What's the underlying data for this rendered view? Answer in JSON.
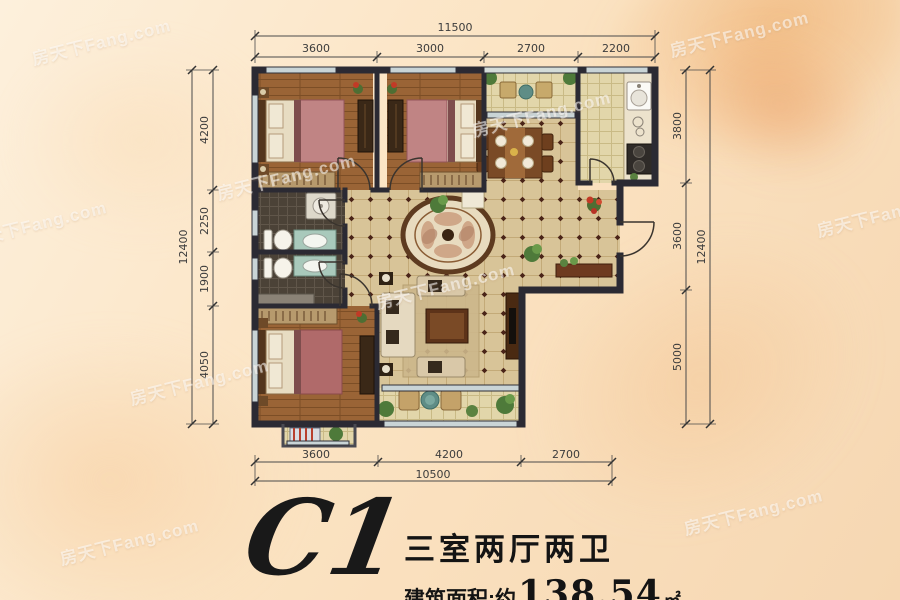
{
  "watermark": {
    "text": "房天下Fang.com"
  },
  "plan": {
    "title_code": "C1",
    "title_layout": "三室两厅两卫",
    "area_label": "建筑面积:约",
    "area_value": "138.54",
    "area_unit": "㎡"
  },
  "dimensions": {
    "top": {
      "total": "11500",
      "segments": [
        "3600",
        "3000",
        "2700",
        "2200"
      ]
    },
    "bottom": {
      "total": "10500",
      "segments": [
        "3600",
        "4200",
        "2700"
      ]
    },
    "left": {
      "total": "12400",
      "segments": [
        "4200",
        "2250",
        "1900",
        "4050"
      ]
    },
    "right": {
      "total": "12400",
      "segments": [
        "3800",
        "3600",
        "5000"
      ]
    }
  },
  "colors": {
    "wall": "#2b2a33",
    "wood_floor": "#9a6436",
    "hall_tile": "#d8c498",
    "bath_tile": "#4b4237",
    "kitchen_tile": "#e2d6aa",
    "dim_line": "#4a4a4a",
    "title_text": "#141414",
    "background": "#fbe3c2"
  }
}
